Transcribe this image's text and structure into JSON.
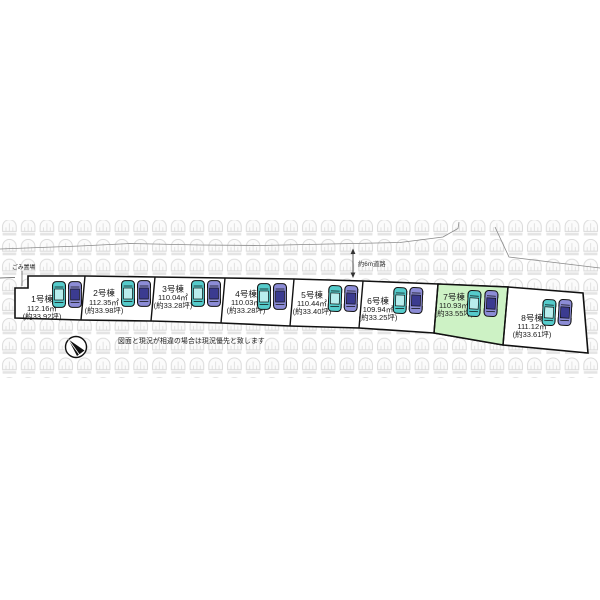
{
  "title": "区画図",
  "site_plan": {
    "garbage_label": "ごみ置場",
    "road_label": "約6m道路",
    "disclaimer": "図面と現況が相違の場合は現況優先と致します",
    "icons": {
      "compass": "north-arrow-icon",
      "watermark": "house-logo-watermark"
    },
    "cars_per_lot": [
      "teal",
      "purple"
    ],
    "lots": [
      {
        "name": "1号棟",
        "area_m2": "112.16㎡",
        "area_tsubo": "(約33.92坪)",
        "highlighted": false
      },
      {
        "name": "2号棟",
        "area_m2": "112.35㎡",
        "area_tsubo": "(約33.98坪)",
        "highlighted": false
      },
      {
        "name": "3号棟",
        "area_m2": "110.04㎡",
        "area_tsubo": "(約33.28坪)",
        "highlighted": false
      },
      {
        "name": "4号棟",
        "area_m2": "110.03㎡",
        "area_tsubo": "(約33.28坪)",
        "highlighted": false
      },
      {
        "name": "5号棟",
        "area_m2": "110.44㎡",
        "area_tsubo": "(約33.40坪)",
        "highlighted": false
      },
      {
        "name": "6号棟",
        "area_m2": "109.94㎡",
        "area_tsubo": "(約33.25坪)",
        "highlighted": false
      },
      {
        "name": "7号棟",
        "area_m2": "110.93㎡",
        "area_tsubo": "(約33.55坪)",
        "highlighted": true
      },
      {
        "name": "8号棟",
        "area_m2": "111.12㎡",
        "area_tsubo": "(約33.61坪)",
        "highlighted": false
      }
    ],
    "colors": {
      "highlight_green": "#cdf2c5",
      "lot_fill": "#ffffff",
      "car_teal": "#55cbcb",
      "car_teal_roof": "#b8eded",
      "car_purple": "#8c8cd6",
      "car_purple_roof": "#3b3b90",
      "pattern_gray": "#d7d7d7",
      "line_black": "#111111"
    }
  }
}
